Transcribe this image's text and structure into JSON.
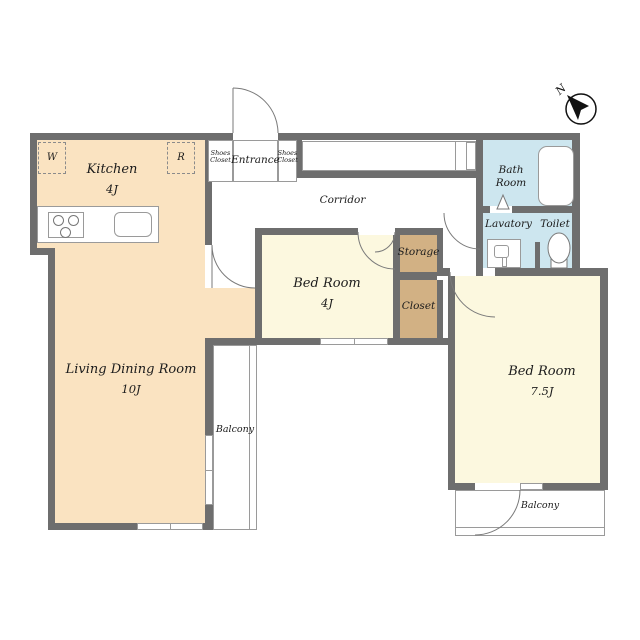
{
  "plan_title": "apartment-floor-plan",
  "colors": {
    "wall": "#6E6E6E",
    "floor_warm": "#FAE3C1",
    "floor_room": "#FCF8DF",
    "floor_wet": "#CDE6EF",
    "floor_closet": "#D2B184"
  },
  "rooms": {
    "kitchen": {
      "name": "Kitchen",
      "size": "4J"
    },
    "living": {
      "name": "Living Dining Room",
      "size": "10J"
    },
    "bedroom_small": {
      "name": "Bed Room",
      "size": "4J"
    },
    "bedroom_large": {
      "name": "Bed Room",
      "size": "7.5J"
    },
    "bath": {
      "line1": "Bath",
      "line2": "Room"
    },
    "lavatory": {
      "name": "Lavatory"
    },
    "toilet": {
      "name": "Toilet"
    },
    "corridor": {
      "name": "Corridor"
    },
    "entrance": {
      "name": "Entrance"
    },
    "storage": {
      "name": "Storage"
    },
    "closet": {
      "name": "Closet"
    },
    "balcony_left": {
      "name": "Balcony"
    },
    "balcony_bottom": {
      "name": "Balcony"
    },
    "shoes_closet_left": {
      "line1": "Shoes",
      "line2": "Closet"
    },
    "shoes_closet_right": {
      "line1": "Shoes",
      "line2": "Closet"
    }
  },
  "markers": {
    "washer": "W",
    "refrigerator": "R",
    "north": "N"
  }
}
